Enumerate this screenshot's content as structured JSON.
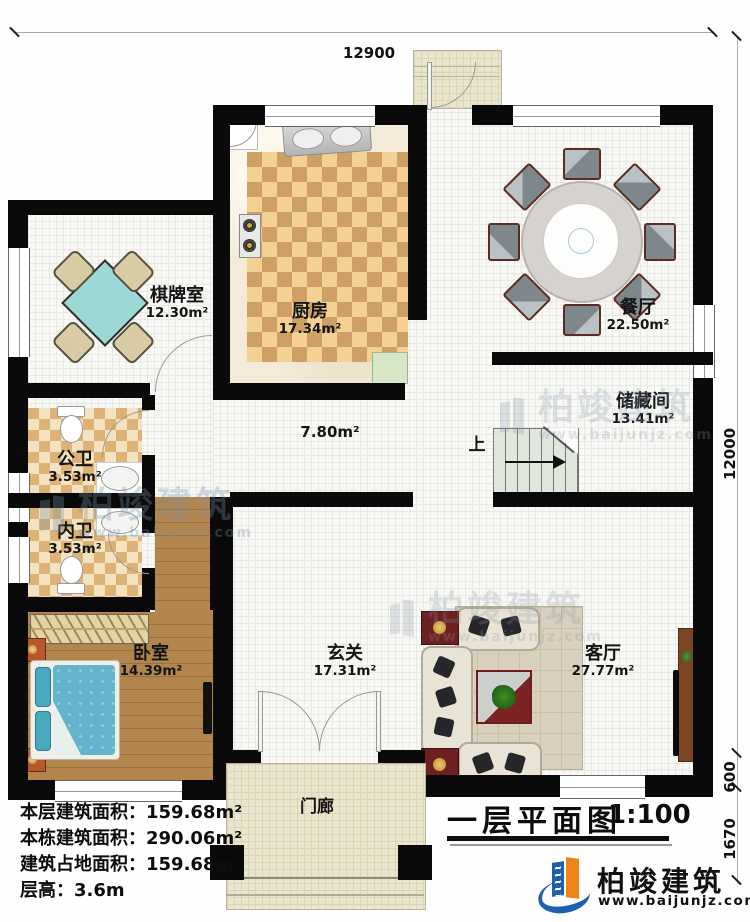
{
  "plan": {
    "title": "一层平面图",
    "scale": "1:100",
    "dimensions": {
      "top": "12900",
      "right_upper": "12000",
      "right_middle": "600",
      "right_lower": "1670"
    },
    "rooms": {
      "chess": {
        "name": "棋牌室",
        "area": "12.30m²"
      },
      "kitchen": {
        "name": "厨房",
        "area": "17.34m²"
      },
      "dining": {
        "name": "餐厅",
        "area": "22.50m²"
      },
      "storage": {
        "name": "储藏间",
        "area": "13.41m²"
      },
      "hall": {
        "area": "7.80m²"
      },
      "public_bath": {
        "name": "公卫",
        "area": "3.53m²"
      },
      "private_bath": {
        "name": "内卫",
        "area": "3.53m²"
      },
      "bedroom": {
        "name": "卧室",
        "area": "14.39m²"
      },
      "foyer": {
        "name": "玄关",
        "area": "17.31m²"
      },
      "living": {
        "name": "客厅",
        "area": "27.77m²"
      },
      "porch": {
        "name": "门廊"
      }
    },
    "stairs": {
      "up_label": "上"
    },
    "info": {
      "line1": "本层建筑面积：159.68m²",
      "line2": "本栋建筑面积：290.06m²",
      "line3": "建筑占地面积：159.68m²",
      "line4": "层高：3.6m"
    },
    "brand": {
      "name": "柏竣建筑",
      "website": "www.baijunjz.com",
      "blue": "#1e5fae",
      "orange": "#f08318"
    },
    "watermark": {
      "name": "柏竣建筑",
      "website": "www.baijunjz.com"
    }
  }
}
